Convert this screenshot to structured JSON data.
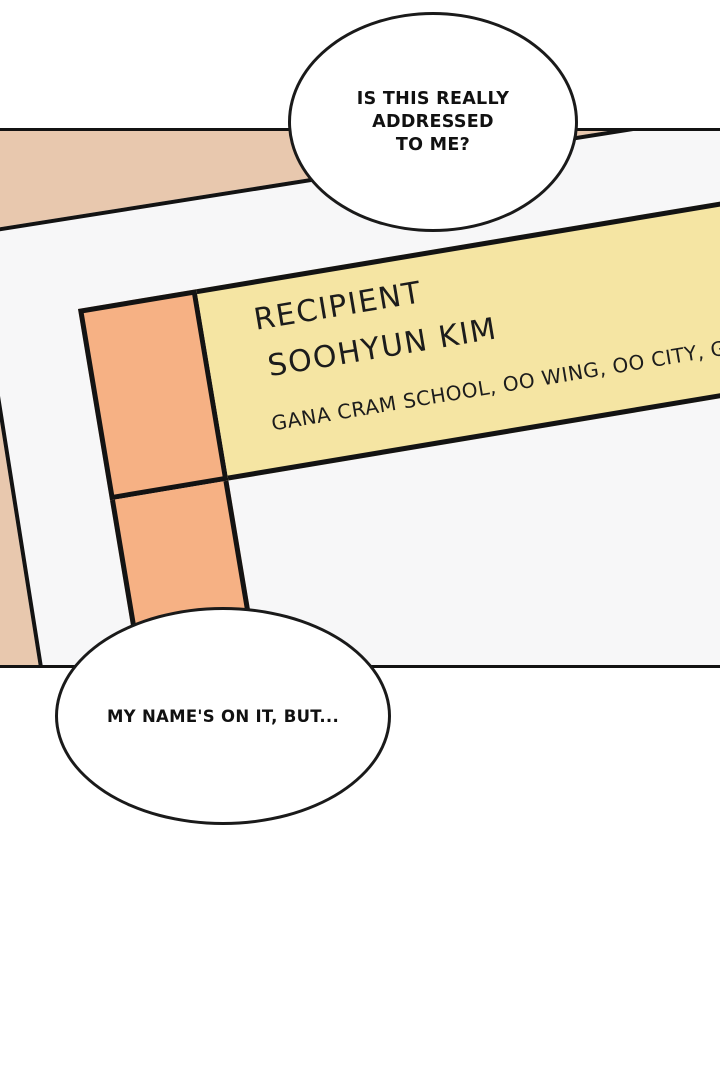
{
  "panel": {
    "label": {
      "recipient_heading": "RECIPIENT",
      "recipient_name": "SOOHYUN KIM",
      "address_line": "GANA CRAM SCHOOL, OO WING, OO CITY, GYEONGGI-DO"
    }
  },
  "speech_bubbles": {
    "top": {
      "line1": "IS THIS REALLY",
      "line2": "ADDRESSED",
      "line3": "TO ME?"
    },
    "bottom": {
      "text": "MY NAME'S ON IT, BUT..."
    }
  },
  "colors": {
    "page_white": "#ffffff",
    "background_tan": "#e8c8ae",
    "envelope_white": "#f7f7f8",
    "label_yellow": "#f5e5a3",
    "label_orange": "#f6b184",
    "line_black": "#131313"
  }
}
